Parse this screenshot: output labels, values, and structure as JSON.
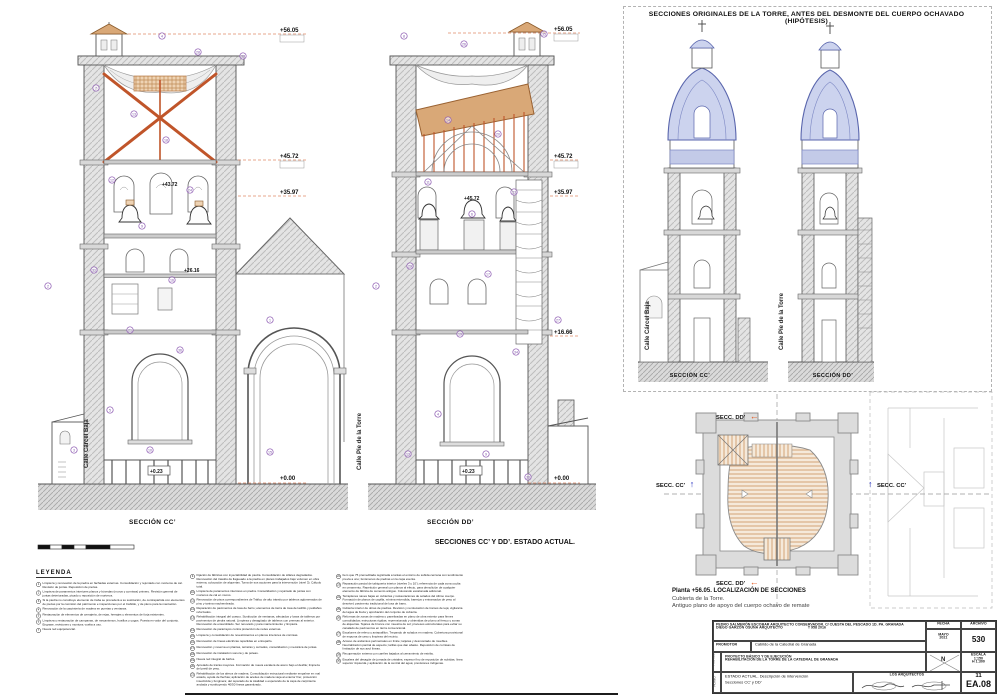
{
  "sheet": {
    "hypothesis_title": "SECCIONES ORIGINALES DE LA TORRE, ANTES DEL DESMONTE DEL CUERPO OCHAVADO (HIPÓTESIS)",
    "left_section_label": "SECCIÓN CC’",
    "right_section_label": "SECCIÓN DD’",
    "hyp_left_label": "SECCIÓN CC’",
    "hyp_right_label": "SECCIÓN DD’",
    "main_caption": "SECCIONES CC’ Y DD’. ESTADO ACTUAL.",
    "plan_title": "Planta +56.05. LOCALIZACIÓN DE SECCIONES",
    "plan_sub1": "Cubierta de la Torre.",
    "plan_sub2": "Antiguo plano de apoyo del cuerpo ochavo de remate",
    "street_left": "Calle Cárcel Baja",
    "street_right": "Calle Pie de la Torre",
    "sec_cc": "SECC. CC’",
    "sec_dd": "SECC. DD’"
  },
  "levels": {
    "l56": "+56.05",
    "l45": "+45.72",
    "l43": "+43.72",
    "l35": "+35.97",
    "l26": "+26.16",
    "l16": "+16.66",
    "l0": "+0.00",
    "l023": "+0.23"
  },
  "legend": {
    "title": "LEYENDA",
    "col1": [
      {
        "n": "1",
        "t": "Limpieza y renovación de la piedra en fachadas externas. Consolidación y rejuntado con morteros de cal. Revisión de juntas. Reposición de piezas."
      },
      {
        "n": "2",
        "t": "Limpieza de paramentos interiores planos y bóvedas (muros y cornisas) primero. Revisión general de juntas deterioradas, picado y reposición de morteros."
      },
      {
        "n": "3",
        "t": "Si la piedra no constituye elemento de traba se procederá a su sustitución, de contrapartida con elementos de piezas por la comisión del patrimonio e inspecciones por el Cabildo, y de pleno para la marcación."
      },
      {
        "n": "4",
        "t": "Renovación de la carpintería de madera en puertas y ventanas."
      },
      {
        "n": "5",
        "t": "Restauración de elementos de cerrajería, de rejas, herrajes y elementos de forja existentes."
      },
      {
        "n": "6",
        "t": "Limpieza y restauración de campanas, de mecanismos, husillos y yugos. Puesta en valor del conjunto. Engrase, revisiones y montura; vuelta a uso."
      },
      {
        "n": "7",
        "t": "Nueva red equipotencial."
      }
    ],
    "col2": [
      {
        "n": "9",
        "t": "Fijación de fábricas con inyectabilidad de piedra. Consolidación de sillares degradados. Renovación del trasdós de llagueado a la piedra en planos trabajados bajo volumen en obra externa, colocación de alquerías. Toma de sus acciones para la intervención (nivel 3). Cálculo total."
      },
      {
        "n": "10",
        "t": "Limpieza de paramentos interiores en piedra. Consolidación y rejuntado de juntas con morteros de cal en muros."
      },
      {
        "n": "11",
        "t": "Renovación de pisos correspondientes de Tráfico de alto tránsito por tableros aglomerados de pino y tarima machembrada."
      },
      {
        "n": "12",
        "t": "Reparación de pavimentos de losa de barro; elementos de tierra de losa de ladrillo y peldaños reforzados."
      },
      {
        "n": "13",
        "t": "Rehabilitación integral del cuerpo. Sustitución de ventanas, afectados y losas de tableros por pavimentos de piedra natural. Limpieza y desagüado de tableros con prensas al exterior. Renovación de ensamblado. Ser renovado y para mantenimiento y limpieza."
      },
      {
        "n": "14",
        "t": "Renovación de pararrayos contra protección de redes externas."
      },
      {
        "n": "15",
        "t": "Limpieza y consolidación de revestimientos en planos interiores de cornisas."
      },
      {
        "n": "16",
        "t": "Renovación de líneas eléctricas repartidas en entrepaño."
      },
      {
        "n": "17",
        "t": "Renovación y reserva en plantas, terrazas y cerrados, consolidación y mecánica de juntas."
      },
      {
        "n": "18",
        "t": "Renovación de instalación sonora y de poleas."
      },
      {
        "n": "19",
        "t": "Nueva red integral de baños."
      },
      {
        "n": "20",
        "t": "Apretado de trazas mayores. Formación de nueva escalera de acero bajo el desfile; limpieza del pretil de yeso."
      },
      {
        "n": "21",
        "t": "Rehabilitación de los aleros de madera. Consolidación estructural mediante empalme en mal estado, ayuda de flechas; aplicación de aceites de madera vieja al exterior fino; protección insecticida y funginera; del reparado de la totalidad o esperando de la capa de carpintería anclada y sustituyendo 40/50 líneas garantizado."
      }
    ],
    "col3": [
      {
        "n": "22",
        "t": "Ítem que 75 premeditada registrada a tantas el entorno de subida cercana con tendimiento previa a uno; fenómenos de piedras en la capa exenta."
      },
      {
        "n": "23",
        "t": "Reparación parcial de tabiquería interior (niveles 3 y 10’); referencia de cada zona oculta en ornamento. Repetición general con planos al efecto, para demolición de cualquier elemento de fábrica de cemento antiguo. Colocando escalonada adicional."
      },
      {
        "n": "24",
        "t": "Terraplenes naves bajas en cubiertas y restauraciones de solados del último cuerpo. Formación de planos de capilla, mínima extendida, barrejos y entramados de yeso al desnivel; pavimento tradicional de losa de barro."
      },
      {
        "n": "25",
        "t": "Cubierta interior de obras de piedras. Revisión y recolocación de tramos de teja; vigilancia del agua de lluvia y aprobación del conjunto de cubierta."
      },
      {
        "n": "26",
        "t": "Reformas de zonas de madera o panelizadas en plano de obra exterior para firmes consolidados; estructuras rígidas; reprensionado y obtenidas de plomo al fresco y zonas de alquerías. Tejares de bronce con muestra de sol; procesos estructurales para evitar su canalado de pavimentos en tierra convencional."
      },
      {
        "n": "27",
        "t": "Escalones de relevo y antepalillos. Trepando de solados en madera. Cobertura provisional de espuma de yeso y limpieza del recinto."
      },
      {
        "n": "28",
        "t": "Acceso de andamios perimetrales en limite; tarjetas y desmontado de muebles. Neutralización parcial de aspecto; tarifas que dan abasto. Reposición de cornisas de limitación de sus azul líneas."
      },
      {
        "n": "29",
        "t": "Recuperación externa con carriles bajados al cerramiento de estribo."
      },
      {
        "n": "30",
        "t": "Escalera del desagüe de jornada de cristales; espesor fino de reposición de subidas; línea superior izquierda y aplicación de la central del agua; previsiones indígenas."
      }
    ],
    "col4": []
  },
  "titleblock": {
    "architect1": "PEDRO SALMERÓN ESCOBAR",
    "architect1_role": "ARQUITECTO CONSERVADOR. C/ CUESTA DEL PESCADO 1D. PA. GRANADA",
    "architect2": "DIEGO GARZÓN OSUNA",
    "architect2_role": "ARQUITECTO",
    "phone": "T 958 2016",
    "promotor_label": "PROMOTOR",
    "promotor": "Cabildo de la Catedral de Granada",
    "proyecto_label": "PROYECTO",
    "proyecto1": "PROYECTO BÁSICO Y DE EJECUCIÓN",
    "proyecto2": "REHABILITACIÓN DE LA TORRE DE LA CATEDRAL DE GRANADA",
    "plano_label": "PLANO",
    "plano1": "ESTADO ACTUAL. Descripción de intervención",
    "plano2": "Secciones CC’ y DD’",
    "fecha_label": "FECHA",
    "fecha1": "MAYO",
    "fecha2": "2021",
    "archivo_label": "ARCHIVO",
    "archivo": "530",
    "escala_label": "ESCALA",
    "escala1": "1:150",
    "escala2": "H 1:300",
    "north": "N",
    "firmas_label": "LOS ARQUITECTOS",
    "sheet_no": "11",
    "sheet_code": "EA.08"
  },
  "markers": {
    "cc": [
      {
        "n": "4",
        "x": 124,
        "y": 14
      },
      {
        "n": "28",
        "x": 160,
        "y": 30
      },
      {
        "n": "33",
        "x": 205,
        "y": 34
      },
      {
        "n": "7",
        "x": 58,
        "y": 66
      },
      {
        "n": "13",
        "x": 96,
        "y": 92
      },
      {
        "n": "18",
        "x": 128,
        "y": 118
      },
      {
        "n": "12",
        "x": 74,
        "y": 158
      },
      {
        "n": "24",
        "x": 152,
        "y": 168
      },
      {
        "n": "9",
        "x": 104,
        "y": 204
      },
      {
        "n": "31",
        "x": 56,
        "y": 248
      },
      {
        "n": "16",
        "x": 134,
        "y": 258
      },
      {
        "n": "2",
        "x": 10,
        "y": 264
      },
      {
        "n": "21",
        "x": 92,
        "y": 308
      },
      {
        "n": "36",
        "x": 142,
        "y": 328
      },
      {
        "n": "5",
        "x": 72,
        "y": 388
      },
      {
        "n": "1",
        "x": 232,
        "y": 298
      },
      {
        "n": "3",
        "x": 36,
        "y": 428
      },
      {
        "n": "10",
        "x": 112,
        "y": 428
      },
      {
        "n": "15",
        "x": 232,
        "y": 430
      }
    ],
    "dd": [
      {
        "n": "8",
        "x": 36,
        "y": 14
      },
      {
        "n": "26",
        "x": 96,
        "y": 22
      },
      {
        "n": "35",
        "x": 176,
        "y": 12
      },
      {
        "n": "14",
        "x": 80,
        "y": 98
      },
      {
        "n": "20",
        "x": 130,
        "y": 112
      },
      {
        "n": "11",
        "x": 60,
        "y": 160
      },
      {
        "n": "23",
        "x": 146,
        "y": 170
      },
      {
        "n": "6",
        "x": 104,
        "y": 192
      },
      {
        "n": "29",
        "x": 42,
        "y": 244
      },
      {
        "n": "17",
        "x": 120,
        "y": 252
      },
      {
        "n": "2",
        "x": 8,
        "y": 264
      },
      {
        "n": "19",
        "x": 92,
        "y": 312
      },
      {
        "n": "34",
        "x": 148,
        "y": 330
      },
      {
        "n": "4",
        "x": 70,
        "y": 392
      },
      {
        "n": "27",
        "x": 190,
        "y": 298
      },
      {
        "n": "13",
        "x": 40,
        "y": 432
      },
      {
        "n": "9",
        "x": 118,
        "y": 432
      },
      {
        "n": "30",
        "x": 160,
        "y": 455
      }
    ]
  }
}
